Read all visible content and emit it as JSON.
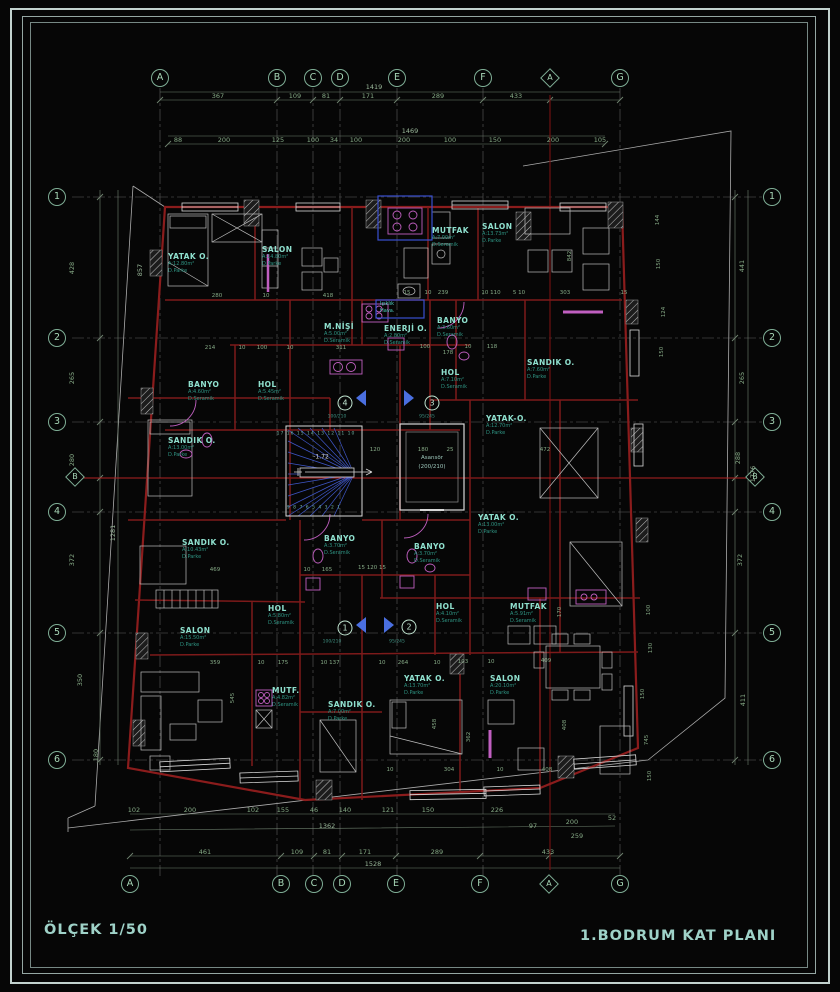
{
  "footer": {
    "scale": "ÖLÇEK 1/50",
    "title": "1.BODRUM KAT PLANI"
  },
  "colors": {
    "wall_red": "#8b1c1c",
    "section_red": "#b22222",
    "axis_teal": "#7fae96",
    "label_teal": "#8fe0ce",
    "dim_green": "#86aa86",
    "blue_accent": "#4a5fd8",
    "magenta_fixture": "#c05fc0",
    "background": "#060606"
  },
  "axes": {
    "top": [
      "A",
      "B",
      "C",
      "D",
      "E",
      "F",
      "G"
    ],
    "top_section": "A",
    "bottom": [
      "A",
      "B",
      "C",
      "D",
      "E",
      "F",
      "G"
    ],
    "bottom_section": "A",
    "left": [
      "1",
      "2",
      "3",
      "4",
      "5",
      "6"
    ],
    "left_section": "B",
    "right": [
      "1",
      "2",
      "3",
      "4",
      "5",
      "6"
    ],
    "right_section": "B"
  },
  "dim_top": {
    "total1": "1419",
    "row1": [
      "367",
      "109",
      "81",
      "171",
      "289",
      "433"
    ],
    "total2": "1469",
    "row2": [
      "88",
      "200",
      "125",
      "100",
      "34",
      "100",
      "200",
      "100",
      "150",
      "200",
      "105"
    ]
  },
  "dim_bottom": {
    "row1": [
      "102",
      "200",
      "102",
      "155",
      "46",
      "140",
      "121",
      "150",
      "226",
      "97",
      "200",
      "52"
    ],
    "mid1": "1362",
    "mid2": "259",
    "row2": [
      "461",
      "109",
      "81",
      "171",
      "289",
      "433"
    ],
    "total": "1528"
  },
  "dim_left": {
    "row": [
      "428",
      "265",
      "280",
      "372",
      "350",
      "180"
    ],
    "long": [
      "857",
      "1281"
    ]
  },
  "dim_right": {
    "row": [
      "441",
      "265",
      "288",
      "372",
      "411"
    ],
    "total": "1776"
  },
  "dim_inner": [
    "280",
    "10",
    "418",
    "15",
    "10",
    "239",
    "10 110",
    "5 10",
    "303",
    "15",
    "214",
    "10",
    "100",
    "10",
    "311",
    "100",
    "178",
    "10",
    "118",
    "120",
    "180",
    "25",
    "472",
    "469",
    "10",
    "165",
    "15 120 15",
    "359",
    "10",
    "175",
    "10 137",
    "10",
    "264",
    "10",
    "103",
    "10",
    "409",
    "10",
    "304",
    "10",
    "408",
    "842",
    "545",
    "458",
    "362",
    "408",
    "170",
    "144",
    "150",
    "124",
    "150",
    "100",
    "130",
    "150",
    "745",
    "150"
  ],
  "rooms": [
    {
      "name": "YATAK O.",
      "area": "A:12.80m²",
      "floor": "D.Parke"
    },
    {
      "name": "SALON",
      "area": "A:14.80m²",
      "floor": "D.Parke"
    },
    {
      "name": "MUTFAK",
      "area": "A:7.00m²",
      "floor": "D.Seramik"
    },
    {
      "name": "SALON",
      "area": "A:13.73m²",
      "floor": "D.Parke"
    },
    {
      "name": "M.NİŞİ",
      "area": "A:5.00m²",
      "floor": "D.Seramik"
    },
    {
      "name": "ENERJİ O.",
      "area": "A:2.80m²",
      "floor": "D.Seramik"
    },
    {
      "name": "BANYO",
      "area": "A:3.60m²",
      "floor": "D.Seramik"
    },
    {
      "name": "SANDIK O.",
      "area": "A:7.60m²",
      "floor": "D.Parke"
    },
    {
      "name": "HOL",
      "area": "A:7.10m²",
      "floor": "D.Seramik"
    },
    {
      "name": "BANYO",
      "area": "A:4.60m²",
      "floor": "D.Seramik"
    },
    {
      "name": "HOL",
      "area": "A:5.45m²",
      "floor": "D.Seramik"
    },
    {
      "name": "SANDIK O.",
      "area": "A:13.00m²",
      "floor": "D.Parke"
    },
    {
      "name": "YATAK-O.",
      "area": "A:12.70m²",
      "floor": "D.Parke"
    },
    {
      "name": "YATAK O.",
      "area": "A:13.00m²",
      "floor": "D.Parke"
    },
    {
      "name": "BANYO",
      "area": "A:3.70m²",
      "floor": "D.Seramik"
    },
    {
      "name": "BANYO",
      "area": "A:3.70m²",
      "floor": "D.Seramik"
    },
    {
      "name": "SANDIK O.",
      "area": "A:10.43m²",
      "floor": "D.Parke"
    },
    {
      "name": "HOL",
      "area": "A:5.80m²",
      "floor": "D.Seramik"
    },
    {
      "name": "SALON",
      "area": "A:15.50m²",
      "floor": "D.Parke"
    },
    {
      "name": "MUTF.",
      "area": "A:4.82m²",
      "floor": "D.Seramik"
    },
    {
      "name": "SANDIK O.",
      "area": "A:7.00m²",
      "floor": "D.Parke"
    },
    {
      "name": "HOL",
      "area": "A:4.10m²",
      "floor": "D.Seramik"
    },
    {
      "name": "MUTFAK",
      "area": "A:5.91m²",
      "floor": "D.Seramik"
    },
    {
      "name": "YATAK O.",
      "area": "A:13.70m²",
      "floor": "D.Parke"
    },
    {
      "name": "SALON",
      "area": "A:20.10m²",
      "floor": "D.Parke"
    }
  ],
  "units": [
    "1",
    "2",
    "3",
    "4"
  ],
  "door_tags": [
    "100/210",
    "95/245",
    "100/210",
    "95/245"
  ],
  "stair": {
    "level": "-1.72",
    "top_nums": "17 16 15 14 13 12 11 10",
    "bottom_nums": "9 8 7 6 5 4 3 2 1"
  },
  "elevator": {
    "name": "Asansör",
    "size": "(200/210)"
  },
  "shaft": {
    "line1": "Işıklık",
    "line2": "Hava."
  }
}
